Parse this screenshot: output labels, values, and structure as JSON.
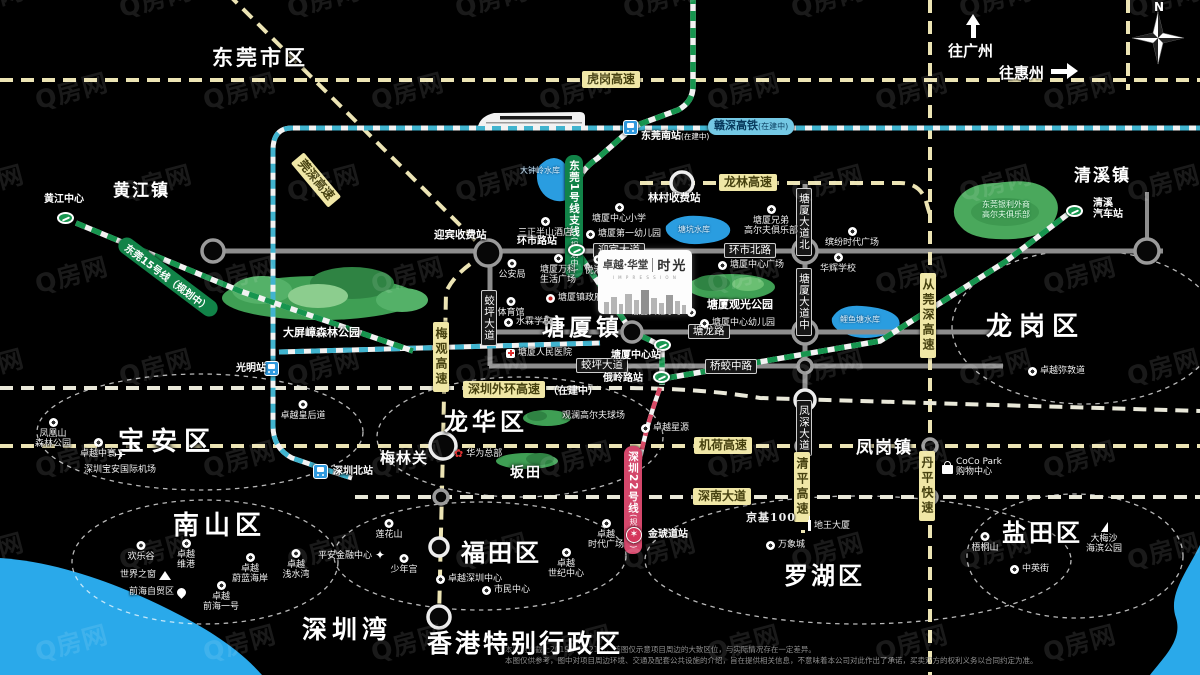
{
  "watermark": "Q房网",
  "compass": {
    "n": "N"
  },
  "directions": {
    "guangzhou": "往广州",
    "huizhou": "往惠州"
  },
  "logo": {
    "brand": "卓越·华堂",
    "tagline": "I M P R E S S I O N",
    "name": "时光"
  },
  "disclaimer": {
    "line1": "本图制作截止2019年5月21日，该图仅示意项目周边的大致区位，与实际情况存在一定差异。",
    "line2": "本图仅供参考，图中对项目周边环境、交通及配套公共设施的介绍，旨在提供相关信息，不意味着本公司对此作出了承诺，买卖双方的权利义务以合同约定为准。"
  },
  "districts": [
    {
      "t": "东莞市区",
      "x": 212,
      "y": 42,
      "fs": 21,
      "ls": 3
    },
    {
      "t": "黄江镇",
      "x": 113,
      "y": 176,
      "fs": 17,
      "ls": 2
    },
    {
      "t": "清溪镇",
      "x": 1074,
      "y": 161,
      "fs": 17,
      "ls": 2
    },
    {
      "t": "塘厦镇",
      "x": 542,
      "y": 308,
      "fs": 23,
      "ls": 4
    },
    {
      "t": "凤岗镇",
      "x": 856,
      "y": 433,
      "fs": 17,
      "ls": 2
    },
    {
      "t": "坂田",
      "x": 510,
      "y": 462,
      "fs": 14,
      "ls": 2
    },
    {
      "t": "梅林关",
      "x": 380,
      "y": 447,
      "fs": 15,
      "ls": 1
    },
    {
      "t": "深圳湾",
      "x": 302,
      "y": 610,
      "fs": 25,
      "ls": 5
    },
    {
      "t": "香港特别行政区",
      "x": 427,
      "y": 624,
      "fs": 25,
      "ls": 3
    },
    {
      "t": "宝安区",
      "x": 118,
      "y": 421,
      "fs": 26,
      "ls": 7
    },
    {
      "t": "龙华区",
      "x": 444,
      "y": 402,
      "fs": 24,
      "ls": 4
    },
    {
      "t": "南山区",
      "x": 173,
      "y": 505,
      "fs": 26,
      "ls": 5
    },
    {
      "t": "福田区",
      "x": 461,
      "y": 533,
      "fs": 24,
      "ls": 3
    },
    {
      "t": "罗湖区",
      "x": 784,
      "y": 556,
      "fs": 24,
      "ls": 3
    },
    {
      "t": "盐田区",
      "x": 1002,
      "y": 513,
      "fs": 24,
      "ls": 3
    },
    {
      "t": "龙岗区",
      "x": 986,
      "y": 306,
      "fs": 26,
      "ls": 7
    }
  ],
  "circles": [
    {
      "cx": 200,
      "cy": 432,
      "rx": 163,
      "ry": 58
    },
    {
      "cx": 520,
      "cy": 437,
      "rx": 143,
      "ry": 60
    },
    {
      "cx": 205,
      "cy": 562,
      "rx": 133,
      "ry": 62
    },
    {
      "cx": 480,
      "cy": 556,
      "rx": 146,
      "ry": 54
    },
    {
      "cx": 858,
      "cy": 560,
      "rx": 213,
      "ry": 64
    },
    {
      "cx": 1075,
      "cy": 556,
      "rx": 108,
      "ry": 62
    },
    {
      "cx": 1085,
      "cy": 327,
      "rx": 133,
      "ry": 77
    }
  ],
  "hwyLabels": [
    {
      "t": "虎岗高速",
      "x": 582,
      "y": 71
    },
    {
      "t": "龙林高速",
      "x": 719,
      "y": 174
    },
    {
      "t": "机荷高速",
      "x": 694,
      "y": 437
    },
    {
      "t": "深南大道",
      "x": 693,
      "y": 488
    },
    {
      "t": "深圳外环高速",
      "x": 463,
      "y": 381,
      "suf": "（在建中）"
    },
    {
      "t": "梅观高速",
      "x": 433,
      "y": 322,
      "v": 1
    },
    {
      "t": "从莞深高速",
      "x": 920,
      "y": 273,
      "v": 1
    },
    {
      "t": "清平高速",
      "x": 794,
      "y": 452,
      "v": 1
    },
    {
      "t": "丹平快速",
      "x": 919,
      "y": 451,
      "v": 1
    },
    {
      "t": "莞深高速",
      "x": 316,
      "y": 180,
      "rot": 50
    }
  ],
  "roadLabels": [
    {
      "t": "迎宾大道",
      "x": 593,
      "y": 243
    },
    {
      "t": "环市北路",
      "x": 724,
      "y": 243
    },
    {
      "t": "塘龙路",
      "x": 688,
      "y": 324
    },
    {
      "t": "蛟坪大道",
      "x": 576,
      "y": 358
    },
    {
      "t": "桥蛟中路",
      "x": 705,
      "y": 359
    },
    {
      "t": "蛟坪大道",
      "x": 481,
      "y": 290,
      "v": 1
    },
    {
      "t": "塘厦大道北",
      "x": 796,
      "y": 188,
      "v": 1
    },
    {
      "t": "塘厦大道中",
      "x": 796,
      "y": 268,
      "v": 1
    },
    {
      "t": "凤深大道",
      "x": 796,
      "y": 400,
      "v": 1
    }
  ],
  "railLabels": [
    {
      "t": "赣深高铁",
      "suf": "(在建中)",
      "x": 708,
      "y": 118,
      "c": "b"
    },
    {
      "t": "东莞1号线支线",
      "suf": "(规划中)",
      "x": 565,
      "y": 155,
      "c": "g",
      "v": 1
    },
    {
      "t": "东莞15号线（规划中）",
      "x": 168,
      "y": 277,
      "c": "g",
      "rot": 37
    },
    {
      "t": "深圳22号线",
      "suf": "(规划中)",
      "x": 624,
      "y": 446,
      "c": "r",
      "v": 1
    }
  ],
  "tolls": [
    {
      "t": "迎宾收费站",
      "x": 434,
      "y": 227
    },
    {
      "t": "林村收费站",
      "x": 648,
      "y": 190
    }
  ],
  "stations": [
    {
      "t": "黄江中心",
      "ty": "g",
      "x": 57,
      "y": 212,
      "lx": 44,
      "ly": 194
    },
    {
      "t": "环市路站",
      "ty": "g",
      "x": 568,
      "y": 244,
      "lx": 517,
      "ly": 236
    },
    {
      "t": "东莞南站",
      "suf": "(在建中)",
      "ty": "b",
      "x": 623,
      "y": 120,
      "lx": 641,
      "ly": 131
    },
    {
      "t": "塘厦中心站",
      "ty": "g",
      "x": 654,
      "y": 339,
      "lx": 611,
      "ly": 350
    },
    {
      "t": "俄岭路站",
      "ty": "g",
      "x": 653,
      "y": 371,
      "lx": 603,
      "ly": 373
    },
    {
      "t": "清溪\n汽车站",
      "ty": "g",
      "x": 1066,
      "y": 205,
      "lx": 1093,
      "ly": 198
    },
    {
      "t": "光明站",
      "ty": "b",
      "x": 264,
      "y": 361,
      "lx": 236,
      "ly": 363
    },
    {
      "t": "深圳北站",
      "ty": "b",
      "x": 313,
      "y": 464,
      "lx": 333,
      "ly": 466
    },
    {
      "t": "金琥道站",
      "ty": "r",
      "x": 626,
      "y": 527,
      "lx": 648,
      "ly": 529
    }
  ],
  "pois": [
    {
      "t": "公安局",
      "x": 512,
      "y": 259,
      "ic": "b",
      "ip": "t"
    },
    {
      "t": "塘厦万科\n生活广场",
      "x": 558,
      "y": 254,
      "ic": "b",
      "ip": "t"
    },
    {
      "t": "悦港汇",
      "x": 598,
      "y": 255,
      "ic": "b",
      "ip": "t"
    },
    {
      "t": "塘厦镇政府",
      "x": 546,
      "y": 293,
      "ic": "gov",
      "ip": "l"
    },
    {
      "t": "体育馆",
      "x": 511,
      "y": 297,
      "ic": "b",
      "ip": "t"
    },
    {
      "t": "水霖学校",
      "x": 504,
      "y": 317,
      "ic": "b",
      "ip": "l"
    },
    {
      "t": "塘厦实验小学",
      "x": 630,
      "y": 307,
      "ic": "b",
      "ip": "r"
    },
    {
      "t": "塘厦中心幼儿园",
      "x": 700,
      "y": 318,
      "ic": "b",
      "ip": "l"
    },
    {
      "t": "塘厦人民医院",
      "x": 506,
      "y": 348,
      "ic": "hosp",
      "ip": "l"
    },
    {
      "t": "塘厦中心广场",
      "x": 718,
      "y": 260,
      "ic": "b",
      "ip": "l"
    },
    {
      "t": "华辉学校",
      "x": 838,
      "y": 253,
      "ic": "b",
      "ip": "t"
    },
    {
      "t": "缤纷时代广场",
      "x": 852,
      "y": 227,
      "ic": "b",
      "ip": "t"
    },
    {
      "t": "塘厦中心小学",
      "x": 619,
      "y": 203,
      "ic": "b",
      "ip": "t"
    },
    {
      "t": "塘厦第一幼儿园",
      "x": 586,
      "y": 229,
      "ic": "b",
      "ip": "l"
    },
    {
      "t": "塘厦兄弟\n高尔夫俱乐部",
      "x": 771,
      "y": 205,
      "ic": "b",
      "ip": "t"
    },
    {
      "t": "三正半山酒店",
      "x": 545,
      "y": 217,
      "ic": "b",
      "ip": "t"
    },
    {
      "t": "卓越星源",
      "x": 641,
      "y": 423,
      "ic": "b",
      "ip": "l"
    },
    {
      "t": "卓越皇后道",
      "x": 303,
      "y": 400,
      "ic": "b",
      "ip": "t"
    },
    {
      "t": "卓越弥敦道",
      "x": 1028,
      "y": 366,
      "ic": "b",
      "ip": "l"
    },
    {
      "t": "华为总部",
      "x": 454,
      "y": 448,
      "ic": "flower",
      "ip": "l"
    },
    {
      "t": "凤凰山\n森林公园",
      "x": 53,
      "y": 418,
      "ic": "b",
      "ip": "t"
    },
    {
      "t": "卓越中寰",
      "x": 98,
      "y": 438,
      "ic": "b",
      "ip": "t"
    },
    {
      "t": "深圳宝安国际机场",
      "x": 120,
      "y": 448,
      "ic": "plane",
      "ip": "t"
    },
    {
      "t": "欢乐谷",
      "x": 141,
      "y": 541,
      "ic": "b",
      "ip": "t"
    },
    {
      "t": "卓越\n维港",
      "x": 186,
      "y": 539,
      "ic": "b",
      "ip": "t"
    },
    {
      "t": "世界之窗",
      "x": 120,
      "y": 570,
      "ic": "pyr",
      "ip": "r"
    },
    {
      "t": "卓越\n蔚蓝海岸",
      "x": 250,
      "y": 553,
      "ic": "b",
      "ip": "t"
    },
    {
      "t": "卓越\n浅水湾",
      "x": 296,
      "y": 549,
      "ic": "b",
      "ip": "t"
    },
    {
      "t": "前海自贸区",
      "x": 129,
      "y": 587,
      "ic": "fish",
      "ip": "r"
    },
    {
      "t": "卓越\n前海一号",
      "x": 221,
      "y": 581,
      "ic": "b",
      "ip": "t"
    },
    {
      "t": "莲花山",
      "x": 389,
      "y": 519,
      "ic": "b",
      "ip": "t"
    },
    {
      "t": "平安金融中心",
      "x": 318,
      "y": 549,
      "ic": "star",
      "ip": "r"
    },
    {
      "t": "少年宫",
      "x": 404,
      "y": 554,
      "ic": "b",
      "ip": "t"
    },
    {
      "t": "卓越深圳中心",
      "x": 436,
      "y": 574,
      "ic": "b",
      "ip": "l"
    },
    {
      "t": "市民中心",
      "x": 482,
      "y": 585,
      "ic": "b",
      "ip": "l"
    },
    {
      "t": "卓越\n世纪中心",
      "x": 566,
      "y": 548,
      "ic": "b",
      "ip": "t"
    },
    {
      "t": "卓越\n时代广场",
      "x": 606,
      "y": 519,
      "ic": "b",
      "ip": "t"
    },
    {
      "t": "京基100",
      "x": 746,
      "y": 513,
      "ic": "none",
      "ip": "l",
      "cls": "kk"
    },
    {
      "t": "地王大厦",
      "x": 808,
      "y": 520,
      "ic": "tower",
      "ip": "l"
    },
    {
      "t": "万象城",
      "x": 766,
      "y": 540,
      "ic": "b",
      "ip": "l"
    },
    {
      "t": "CoCo Park\n购物中心",
      "x": 942,
      "y": 457,
      "ic": "bag",
      "ip": "l"
    },
    {
      "t": "梧桐山",
      "x": 985,
      "y": 532,
      "ic": "b",
      "ip": "t"
    },
    {
      "t": "大梅沙\n海滨公园",
      "x": 1104,
      "y": 522,
      "ic": "sail",
      "ip": "t"
    },
    {
      "t": "中英街",
      "x": 1010,
      "y": 564,
      "ic": "b",
      "ip": "l"
    },
    {
      "t": "观澜高尔夫球场",
      "x": 562,
      "y": 411,
      "ic": "none",
      "ip": "l"
    },
    {
      "t": "东莞银利外商\n高尔夫俱乐部",
      "x": 1006,
      "y": 200,
      "ic": "none",
      "ip": "t",
      "cls": "on-park"
    }
  ],
  "parkLabels": [
    {
      "t": "大屏嶂森林公园",
      "x": 283,
      "y": 324
    },
    {
      "t": "塘厦观光公园",
      "x": 707,
      "y": 296
    }
  ],
  "lakeLabels": [
    {
      "t": "大钟岭水库",
      "x": 520,
      "y": 165
    },
    {
      "t": "塘坑水库",
      "x": 678,
      "y": 224
    },
    {
      "t": "鲤鱼塘水库",
      "x": 840,
      "y": 314
    }
  ]
}
